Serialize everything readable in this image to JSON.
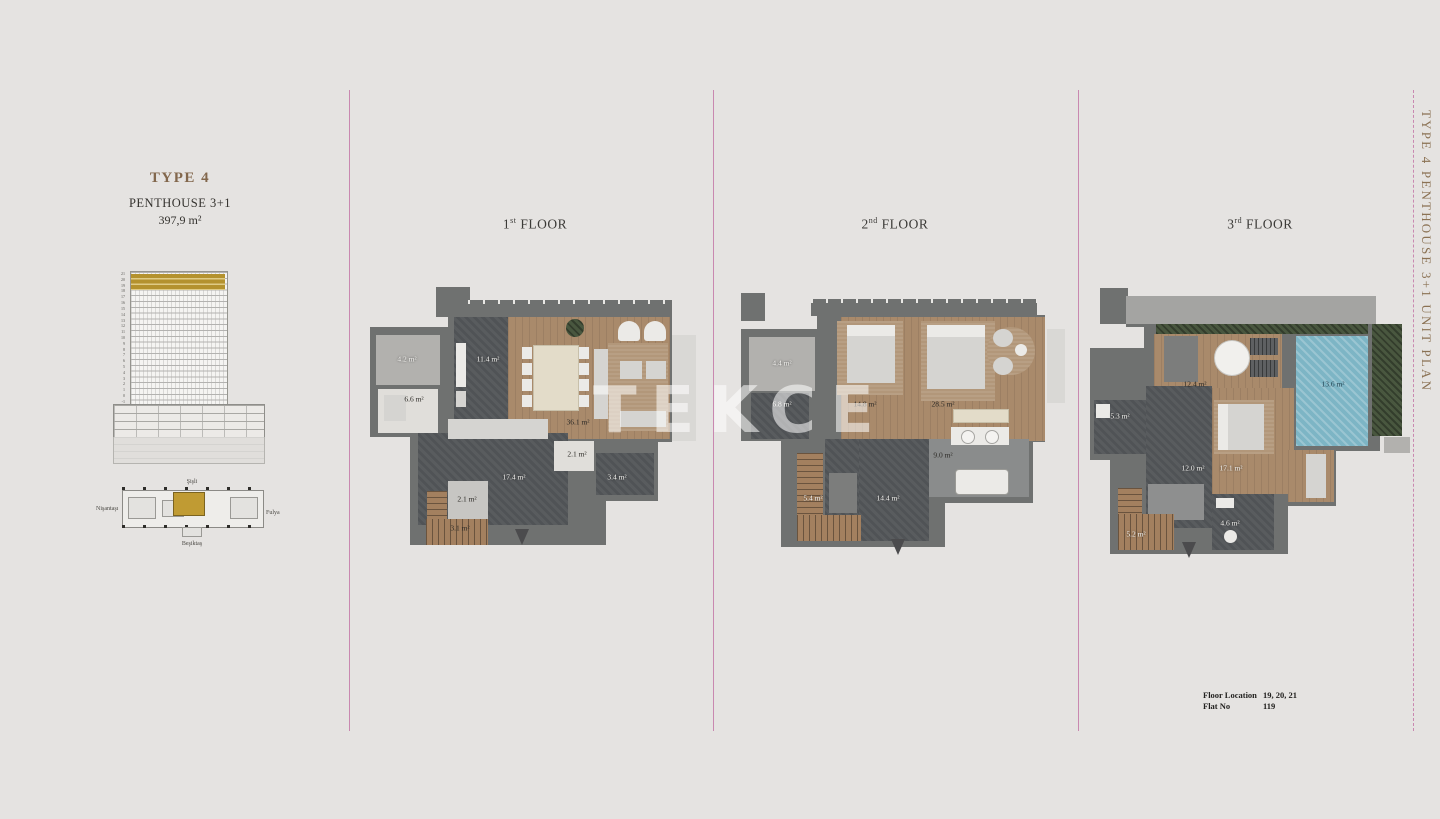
{
  "page": {
    "watermark": "TEKCE"
  },
  "header": {
    "type": "TYPE 4",
    "unit": "PENTHOUSE 3+1",
    "area": "397,9 m²"
  },
  "side_label": "TYPE 4  PENTHOUSE 3+1  UNIT PLAN",
  "elevation": {
    "floor_numbers": [
      "21",
      "20",
      "19",
      "18",
      "17",
      "16",
      "15",
      "14",
      "13",
      "12",
      "11",
      "10",
      "9",
      "8",
      "7",
      "6",
      "5",
      "4",
      "3",
      "2",
      "1",
      "0",
      "-1"
    ]
  },
  "site_plan": {
    "north": "Şişli",
    "west": "Nişantaşı",
    "east": "Fulya",
    "south": "Beşiktaş"
  },
  "plans": [
    {
      "title_num": "1",
      "title_ord": "st",
      "title_word": "FLOOR",
      "rooms": [
        {
          "name": "balcony",
          "area": "4.2 m²"
        },
        {
          "name": "kitchen",
          "area": "11.4 m²"
        },
        {
          "name": "study",
          "area": "6.6 m²"
        },
        {
          "name": "living-dining",
          "area": "36.1 m²"
        },
        {
          "name": "wc",
          "area": "2.1 m²"
        },
        {
          "name": "hall",
          "area": "17.4 m²"
        },
        {
          "name": "storage",
          "area": "3.4 m²"
        },
        {
          "name": "closet",
          "area": "2.1 m²"
        },
        {
          "name": "stairs",
          "area": "3.1 m²"
        }
      ]
    },
    {
      "title_num": "2",
      "title_ord": "nd",
      "title_word": "FLOOR",
      "rooms": [
        {
          "name": "balcony",
          "area": "4.4 m²"
        },
        {
          "name": "laundry",
          "area": "6.8 m²"
        },
        {
          "name": "bedroom",
          "area": "14.8 m²"
        },
        {
          "name": "master-bedroom",
          "area": "28.5 m²"
        },
        {
          "name": "bathroom",
          "area": "9.0 m²"
        },
        {
          "name": "wardrobe",
          "area": "5.4 m²"
        },
        {
          "name": "hall",
          "area": "14.4 m²"
        }
      ]
    },
    {
      "title_num": "3",
      "title_ord": "rd",
      "title_word": "FLOOR",
      "rooms": [
        {
          "name": "terrace",
          "area": "12.4 m²"
        },
        {
          "name": "pool",
          "area": "13.6 m²"
        },
        {
          "name": "utility",
          "area": "5.3 m²"
        },
        {
          "name": "hall",
          "area": "12.0 m²"
        },
        {
          "name": "bedroom",
          "area": "17.1 m²"
        },
        {
          "name": "bathroom",
          "area": "4.6 m²"
        },
        {
          "name": "stairs",
          "area": "5.2 m²"
        }
      ]
    }
  ],
  "footer": {
    "floor_location_label": "Floor Location",
    "floor_location_value": "19, 20, 21",
    "flat_no_label": "Flat No",
    "flat_no_value": "119"
  },
  "colors": {
    "accent_gold": "#8b7254",
    "divider_pink": "#c988b0",
    "highlight_gold": "#b4922e"
  }
}
